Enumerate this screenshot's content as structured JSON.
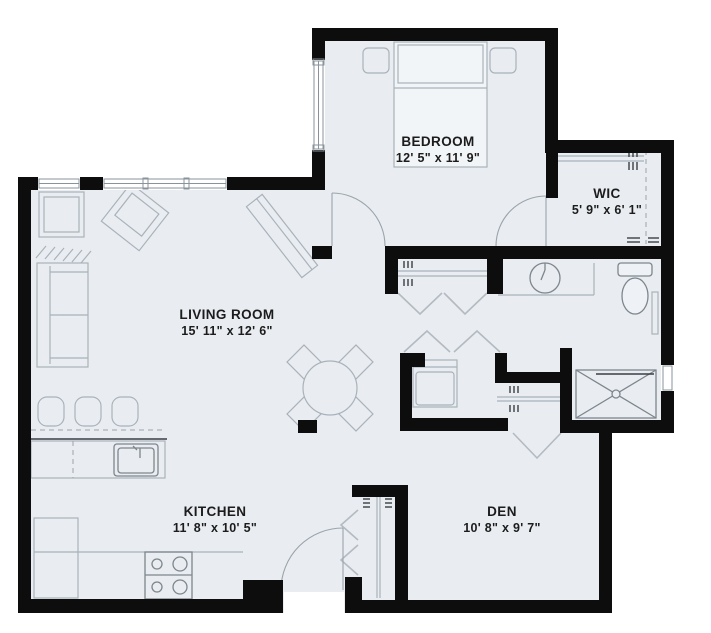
{
  "plan": {
    "type": "floor-plan",
    "colors": {
      "wall": "#0d0d0d",
      "floor": "#e9edf2",
      "outside": "#ffffff",
      "furniture_line": "#a9b2ba",
      "fixture_line": "#7d868d",
      "label": "#1c1c1c"
    },
    "rooms": [
      {
        "name": "BEDROOM",
        "dims": "12' 5\" x 11' 9\""
      },
      {
        "name": "WIC",
        "dims": "5' 9\" x 6' 1\""
      },
      {
        "name": "LIVING ROOM",
        "dims": "15' 11\" x 12' 6\""
      },
      {
        "name": "KITCHEN",
        "dims": "11' 8\" x 10' 5\""
      },
      {
        "name": "DEN",
        "dims": "10' 8\" x 9' 7\""
      }
    ],
    "symbols": [
      "bed",
      "nightstand",
      "closet-shelf",
      "hanging-rod",
      "vanity-sink",
      "toilet",
      "shower",
      "washer",
      "sofa",
      "armchair",
      "console",
      "dining-table",
      "bar-stool",
      "kitchen-sink",
      "range",
      "refrigerator",
      "entry-door",
      "bifold-door"
    ]
  }
}
